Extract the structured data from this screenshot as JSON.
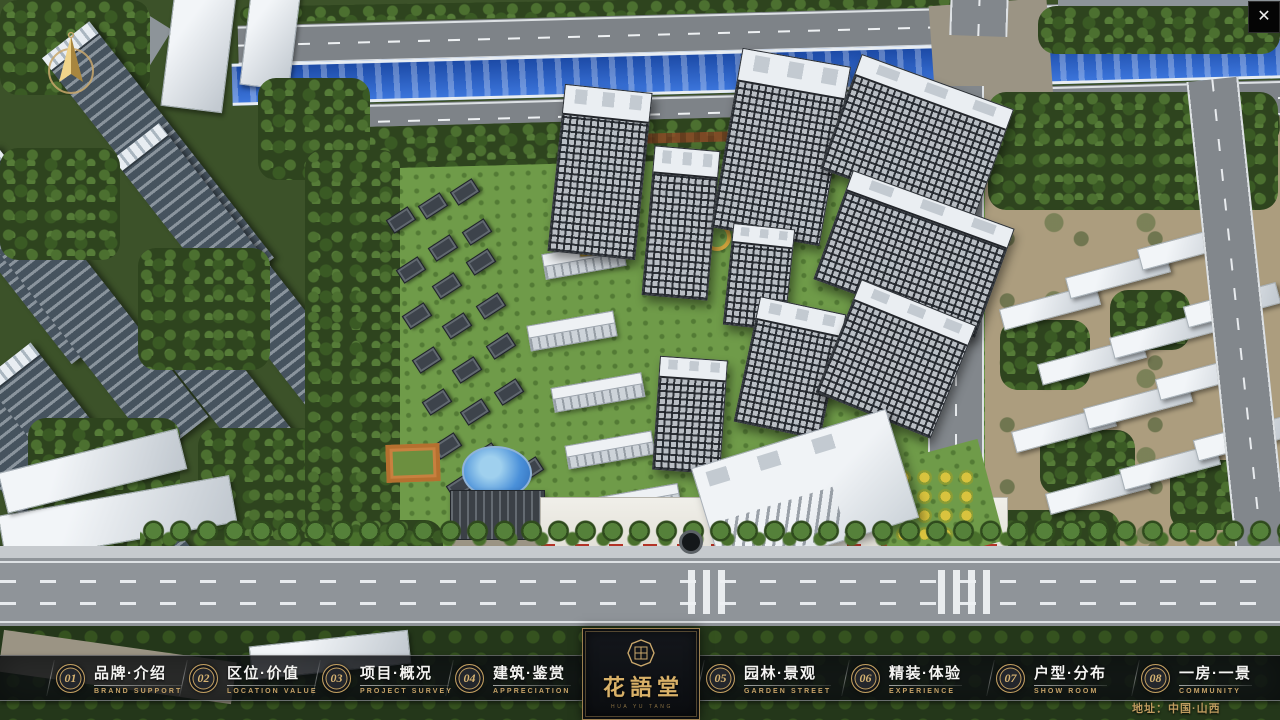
{
  "window": {
    "close_label": "✕"
  },
  "navbar": {
    "items": [
      {
        "num": "01",
        "label": "品牌·介绍",
        "sub": "BRAND SUPPORT"
      },
      {
        "num": "02",
        "label": "区位·价值",
        "sub": "LOCATION VALUE"
      },
      {
        "num": "03",
        "label": "项目·概况",
        "sub": "PROJECT SURVEY"
      },
      {
        "num": "04",
        "label": "建筑·鉴赏",
        "sub": "APPRECIATION"
      },
      {
        "num": "05",
        "label": "园林·景观",
        "sub": "GARDEN STREET"
      },
      {
        "num": "06",
        "label": "精装·体验",
        "sub": "EXPERIENCE"
      },
      {
        "num": "07",
        "label": "户型·分布",
        "sub": "SHOW ROOM"
      },
      {
        "num": "08",
        "label": "一房·一景",
        "sub": "COMMUNITY"
      }
    ]
  },
  "logo": {
    "title": "花語堂",
    "tagline": "HUA YU TANG"
  },
  "footer": {
    "address": "地址：中国·山西"
  },
  "colors": {
    "gold": "#c8a564",
    "navbar_bg": "rgba(14,16,20,0.8)",
    "river_blue": "#2763cf"
  }
}
